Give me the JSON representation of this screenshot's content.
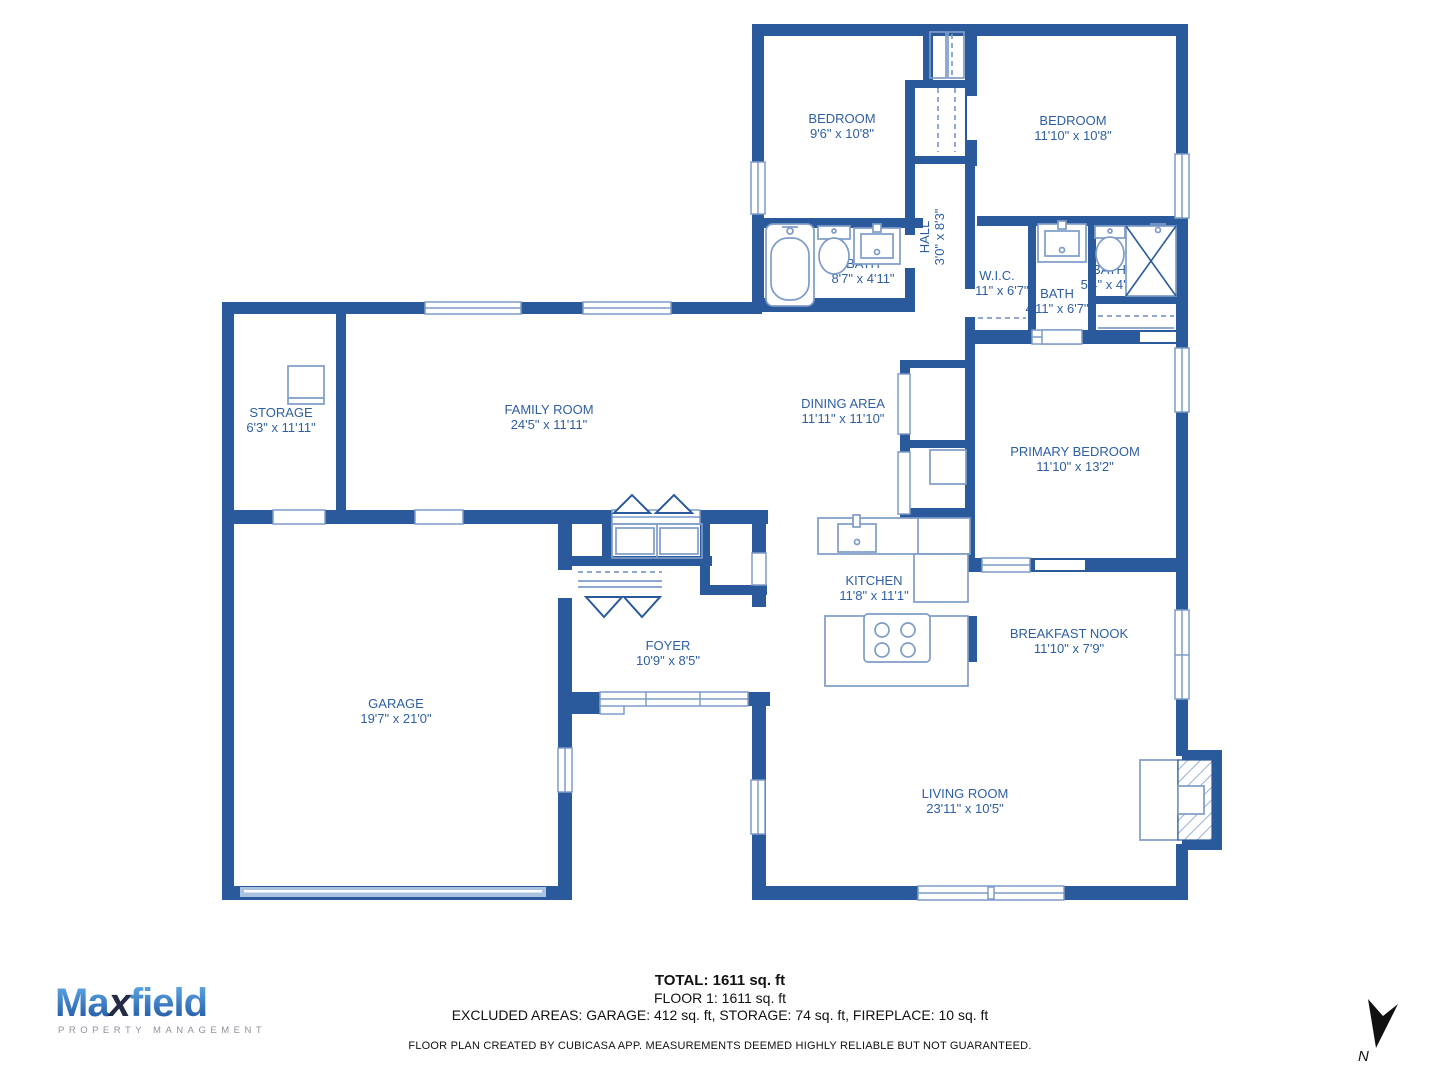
{
  "plan": {
    "rooms": [
      {
        "id": "bedroom-1",
        "name": "BEDROOM",
        "dims": "9'6\" x 10'8\""
      },
      {
        "id": "bedroom-2",
        "name": "BEDROOM",
        "dims": "11'10\" x 10'8\""
      },
      {
        "id": "hall",
        "name": "HALL",
        "dims": "3'0\" x 8'3\""
      },
      {
        "id": "bath-1",
        "name": "BATH",
        "dims": "8'7\" x 4'11\""
      },
      {
        "id": "wic",
        "name": "W.I.C.",
        "dims": "2'11\" x 6'7\""
      },
      {
        "id": "bath-2",
        "name": "BATH",
        "dims": "4'11\" x 6'7\""
      },
      {
        "id": "bath-3",
        "name": "BATH",
        "dims": "5'4\" x 4'3\""
      },
      {
        "id": "storage",
        "name": "STORAGE",
        "dims": "6'3\" x 11'11\""
      },
      {
        "id": "family-room",
        "name": "FAMILY ROOM",
        "dims": "24'5\" x 11'11\""
      },
      {
        "id": "dining-area",
        "name": "DINING AREA",
        "dims": "11'11\" x 11'10\""
      },
      {
        "id": "primary-bedroom",
        "name": "PRIMARY BEDROOM",
        "dims": "11'10\" x 13'2\""
      },
      {
        "id": "kitchen",
        "name": "KITCHEN",
        "dims": "11'8\" x 11'1\""
      },
      {
        "id": "breakfast-nook",
        "name": "BREAKFAST NOOK",
        "dims": "11'10\" x 7'9\""
      },
      {
        "id": "foyer",
        "name": "FOYER",
        "dims": "10'9\" x 8'5\""
      },
      {
        "id": "garage",
        "name": "GARAGE",
        "dims": "19'7\" x 21'0\""
      },
      {
        "id": "living-room",
        "name": "LIVING ROOM",
        "dims": "23'11\" x 10'5\""
      }
    ]
  },
  "summary": {
    "total": "TOTAL: 1611 sq. ft",
    "floor": "FLOOR 1: 1611 sq. ft",
    "excluded": "EXCLUDED AREAS: GARAGE: 412 sq. ft, STORAGE: 74 sq. ft, FIREPLACE: 10 sq. ft",
    "disclaimer": "FLOOR PLAN CREATED BY CUBICASA APP. MEASUREMENTS DEEMED HIGHLY RELIABLE BUT NOT GUARANTEED."
  },
  "logo": {
    "part1": "Ma",
    "part2": "x",
    "part3": "field",
    "tagline": "PROPERTY MANAGEMENT"
  },
  "compass": {
    "label": "N"
  },
  "colors": {
    "wall": "#2a5a9b",
    "label_text": "#2e5fa3",
    "fixture": "#7e9cc8",
    "garage_door": "#a9c3e1",
    "logo_blue_top": "#63b0ea",
    "logo_blue_bottom": "#1c4f9e",
    "logo_dark": "#232b45",
    "logo_gray": "#8d939d"
  }
}
